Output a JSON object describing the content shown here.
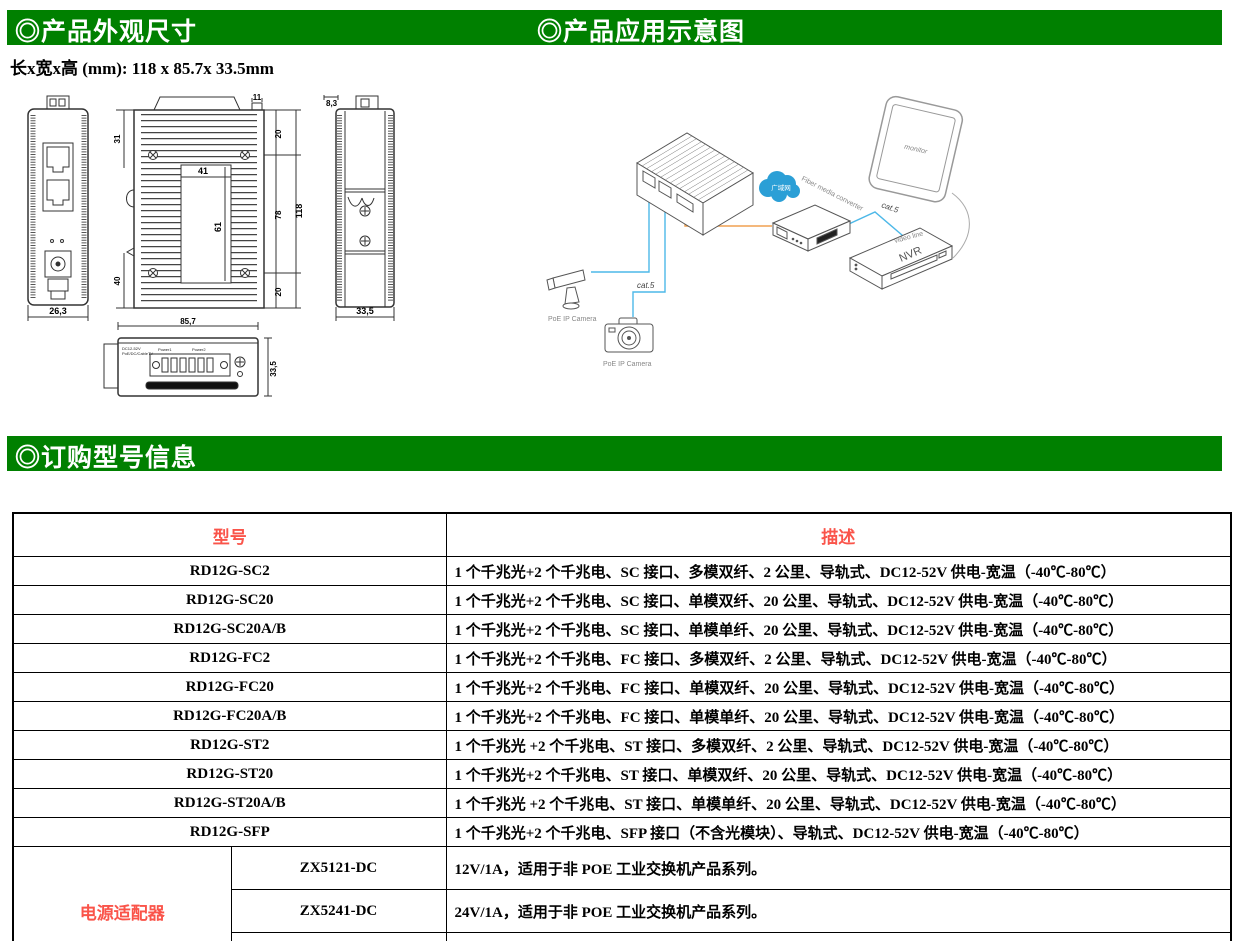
{
  "colors": {
    "accent_green": "#008000",
    "accent_red": "#fa544a",
    "line_blue": "#4db8e8",
    "line_orange": "#f0a050"
  },
  "sections": {
    "appearance_title": "◎产品外观尺寸",
    "application_title": "◎产品应用示意图",
    "ordering_title": "◎订购型号信息"
  },
  "dimensions_note": "长x宽x高 (mm): 118 x 85.7x 33.5mm",
  "drawings": {
    "front_view": {
      "width_label": "26,3"
    },
    "rear_view": {
      "top_tab": "11",
      "left_top": "31",
      "left_bottom": "40",
      "inner_width": "41",
      "inner_height": "61",
      "right_top": "20",
      "right_mid": "78",
      "right_bottom": "20",
      "total_height": "118"
    },
    "side_view": {
      "top_label": "8,3",
      "width_label": "33,5"
    },
    "bottom_view": {
      "width_label": "85,7",
      "height_label": "33,5",
      "print_line1": "DC12-52V",
      "print_line2": "PoE/DC/CableTV",
      "power1": "Power1",
      "power2": "Power2"
    }
  },
  "application_diagram": {
    "cloud": "广域网",
    "fiber_converter": "Fiber media converter",
    "monitor": "monitor",
    "nvr": "NVR",
    "video_line": "video line",
    "cat5_a": "cat.5",
    "cat5_b": "cat.5",
    "camera1": "PoE IP Camera",
    "camera2": "PoE IP Camera"
  },
  "order_table": {
    "headers": {
      "model": "型号",
      "description": "描述"
    },
    "rows": [
      {
        "model": "RD12G-SC2",
        "desc": "1 个千兆光+2 个千兆电、SC 接口、多模双纤、2 公里、导轨式、DC12-52V 供电-宽温（-40℃-80℃）"
      },
      {
        "model": "RD12G-SC20",
        "desc": "1 个千兆光+2 个千兆电、SC 接口、单模双纤、20 公里、导轨式、DC12-52V 供电-宽温（-40℃-80℃）"
      },
      {
        "model": "RD12G-SC20A/B",
        "desc": "1 个千兆光+2 个千兆电、SC 接口、单模单纤、20 公里、导轨式、DC12-52V 供电-宽温（-40℃-80℃）"
      },
      {
        "model": "RD12G-FC2",
        "desc": "1 个千兆光+2 个千兆电、FC 接口、多模双纤、2 公里、导轨式、DC12-52V 供电-宽温（-40℃-80℃）"
      },
      {
        "model": "RD12G-FC20",
        "desc": "1 个千兆光+2 个千兆电、FC 接口、单模双纤、20 公里、导轨式、DC12-52V 供电-宽温（-40℃-80℃）"
      },
      {
        "model": "RD12G-FC20A/B",
        "desc": "1 个千兆光+2 个千兆电、FC 接口、单模单纤、20 公里、导轨式、DC12-52V 供电-宽温（-40℃-80℃）"
      },
      {
        "model": "RD12G-ST2",
        "desc": "1 个千兆光 +2 个千兆电、ST 接口、多模双纤、2 公里、导轨式、DC12-52V 供电-宽温（-40℃-80℃）"
      },
      {
        "model": "RD12G-ST20",
        "desc": "1 个千兆光+2 个千兆电、ST 接口、单模双纤、20 公里、导轨式、DC12-52V 供电-宽温（-40℃-80℃）"
      },
      {
        "model": "RD12G-ST20A/B",
        "desc": "1 个千兆光 +2 个千兆电、ST 接口、单模单纤、20 公里、导轨式、DC12-52V 供电-宽温（-40℃-80℃）"
      },
      {
        "model": "RD12G-SFP",
        "desc": "1 个千兆光+2 个千兆电、SFP 接口（不含光模块）、导轨式、DC12-52V 供电-宽温（-40℃-80℃）"
      }
    ],
    "power_adapters": {
      "group_label": "电源适配器",
      "rows": [
        {
          "model": "ZX5121-DC",
          "desc": "12V/1A，适用于非 POE 工业交换机产品系列。"
        },
        {
          "model": "ZX5241-DC",
          "desc": "24V/1A，适用于非 POE 工业交换机产品系列。"
        },
        {
          "model": "ZX5521-DC",
          "desc": "52V/1A，适用于 1 端口内 POE 供电和非 POE 工业交换机产品系列"
        }
      ]
    }
  }
}
